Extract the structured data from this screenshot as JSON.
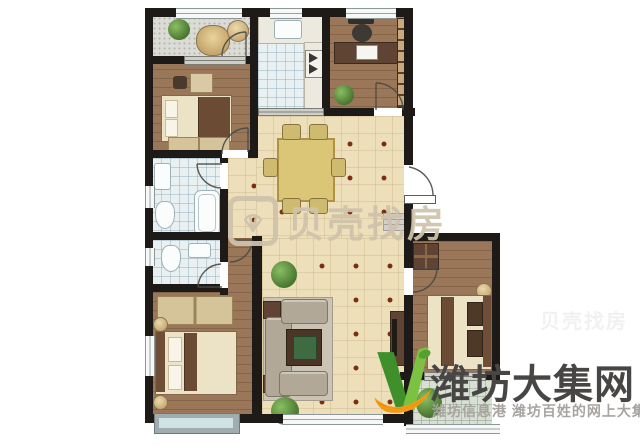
{
  "watermarks": {
    "center": {
      "brand": "贝壳找房",
      "icon": "shell-logo"
    },
    "corner": {
      "title": "潍坊大集网",
      "subtitle": "潍坊信息港 潍坊百姓的网上大集",
      "icon": "v-leaf-logo"
    }
  },
  "colors": {
    "wall": "#1d1a17",
    "wood_floor": "#9a7758",
    "beige_tile": "#ecdfba",
    "bath_tile": "#e9f0f1",
    "accent_dot": "#7c2d12",
    "center_watermark": "#cfc3ac",
    "corner_title": "#474644",
    "corner_subtitle": "#a7a4a0",
    "logo_green": "#55a12f",
    "logo_orange": "#f39c12"
  }
}
